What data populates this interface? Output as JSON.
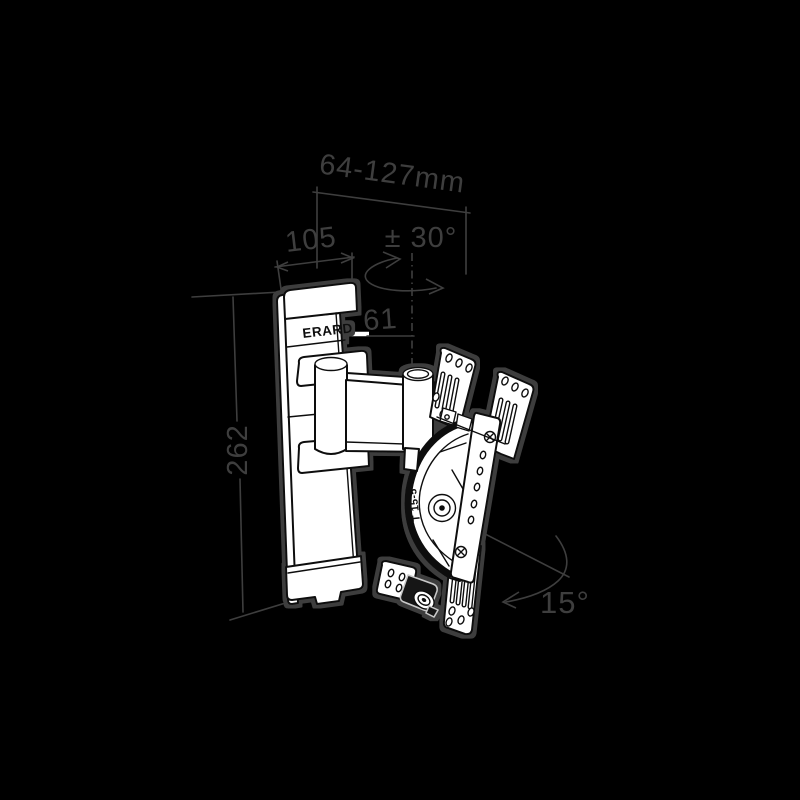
{
  "diagram": {
    "type": "technical-line-drawing",
    "subject": "articulating TV wall mount bracket, isometric view",
    "brand_label": "ERARD",
    "mechanism_label": "T 15-5",
    "dimensions": {
      "depth_range": "64-127mm",
      "wall_plate_width": "105",
      "swivel_angle": "± 30°",
      "pivot_offset": "61",
      "wall_plate_height": "262",
      "tilt_angle": "15°"
    },
    "colors": {
      "background": "#000000",
      "annotation_gray": "#3e3e3e",
      "line_art_fill": "#ffffff",
      "line_art_stroke": "#101010",
      "halo_gray": "#3c3c3c",
      "highlight_leader_white": "#ffffff"
    }
  }
}
